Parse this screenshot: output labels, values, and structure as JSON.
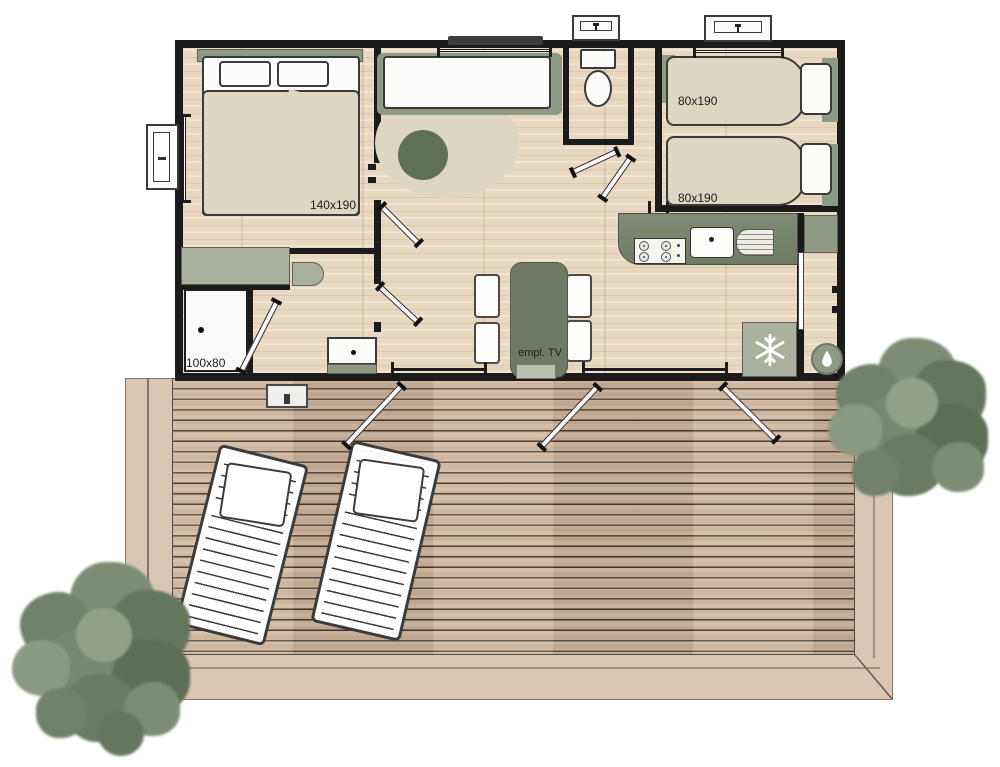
{
  "labels": {
    "bed_main": "140x190",
    "bed_twin_top": "80x190",
    "bed_twin_bottom": "80x190",
    "shower": "100x80",
    "tv_spot": "empl. TV"
  },
  "icons": {
    "fridge": "snowflake-icon",
    "water_heater": "water-drop-icon"
  },
  "colors": {
    "wall": "#1b1b1b",
    "sage_dark": "#6e7a63",
    "sage": "#8f9a84",
    "sage_light": "#a9b19e",
    "cream": "#ddd6c0",
    "deck_plank": "#c9b098",
    "deck_border": "#d9c7b3",
    "floor_wood": "#e8d8c0",
    "tree_foliage": "#76866c"
  }
}
